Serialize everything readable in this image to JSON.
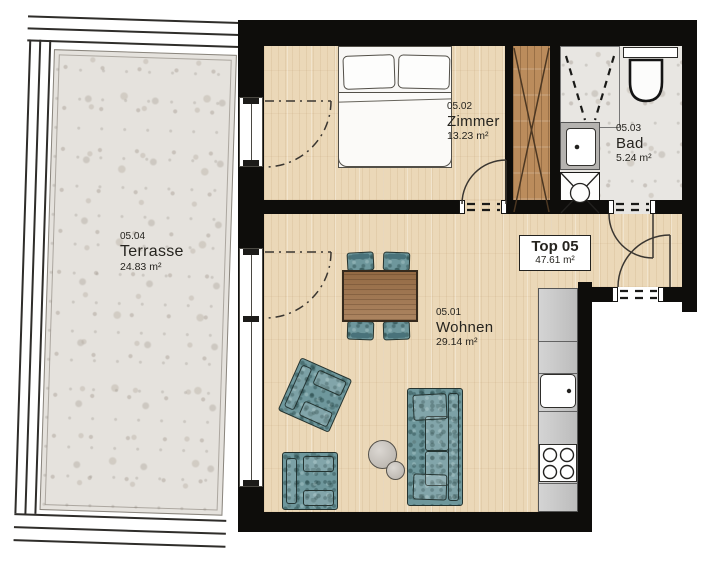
{
  "plan": {
    "unit": {
      "label": "Top 05",
      "area": "47.61 m²"
    },
    "rooms": [
      {
        "code": "05.02",
        "name": "Zimmer",
        "area": "13.23 m²"
      },
      {
        "code": "05.03",
        "name": "Bad",
        "area": "5.24 m²"
      },
      {
        "code": "05.01",
        "name": "Wohnen",
        "area": "29.14 m²"
      },
      {
        "code": "05.04",
        "name": "Terrasse",
        "area": "24.83 m²"
      }
    ],
    "colors": {
      "wall": "#0e0d0b",
      "wood_floor": "#ebd8b8",
      "stone_floor": "#e5e2dd",
      "upholstery_teal": "#6e979c",
      "shaft_wood": "#bb8c5c",
      "table_wood": "#a0734a",
      "kitchen_counter": "#c8c8c8"
    }
  }
}
